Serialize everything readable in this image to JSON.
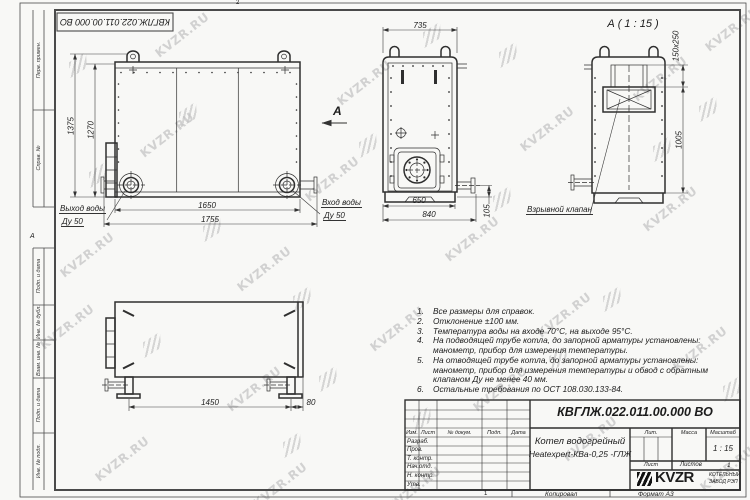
{
  "watermark": {
    "text": "KVZR.RU"
  },
  "frame": {
    "doc_number_rotated": "КВГЛЖ.022.011.00.000 ВО",
    "zone_top": "2",
    "zone_left": "А",
    "zone_bottom": "1",
    "fields": {
      "perv": "Перв. примен.",
      "sprav": "Справ. №",
      "podp1": "Подп. и дата",
      "inv_dubl": "Инв. № дубл.",
      "vzam": "Взам. инв. №",
      "podp2": "Подп. и дата",
      "inv_podl": "Инв. № подл."
    }
  },
  "front_view": {
    "dim_1375": "1375",
    "dim_1270": "1270",
    "dim_1650": "1650",
    "dim_1755": "1755",
    "outlet_label": "Выход воды",
    "outlet_dn": "Ду 50",
    "inlet_label": "Вход воды",
    "inlet_dn": "Ду 50",
    "arrow_label": "А"
  },
  "side_view": {
    "dim_735": "735",
    "dim_650": "650",
    "dim_840": "840",
    "dim_105": "105"
  },
  "section_view": {
    "title": "А ( 1 : 15 )",
    "dim_valve": "150x250",
    "dim_1005": "1005",
    "valve_label": "Взрывной клапан"
  },
  "top_view": {
    "dim_1450": "1450",
    "dim_80": "80"
  },
  "notes": [
    {
      "num": "1.",
      "text": "Все размеры для справок."
    },
    {
      "num": "2.",
      "text": "Отклонение ±100 мм."
    },
    {
      "num": "3.",
      "text": "Температура воды на входе 70°С, на выходе 95°С."
    },
    {
      "num": "4.",
      "text": "На подводящей трубе котла, до запорной арматуры установлены: манометр, прибор для измерения температуры."
    },
    {
      "num": "5.",
      "text": "На отводящей трубе котла, до запорной арматуры установлены: манометр, прибор для измерения температуры и обвод с обратным клапаном Ду не менее 40 мм."
    },
    {
      "num": "6.",
      "text": "Остальные требования по ОСТ 108.030.133-84."
    }
  ],
  "title_block": {
    "doc_number": "КВГЛЖ.022.011.00.000 ВО",
    "name_line1": "Котел водогрейный",
    "name_line2": "Heatexpert-КВа-0,25 -ГЛЖ",
    "col_izm": "Изм.",
    "col_list": "Лист",
    "col_doc": "№ докум.",
    "col_podp": "Подп.",
    "col_data": "Дата",
    "row_razrab": "Разраб.",
    "row_prov": "Пров.",
    "row_tkontr": "Т. контр.",
    "row_nachotd": "Нач.отд.",
    "row_nkontr": "Н. контр.",
    "row_utv": "Утв.",
    "lit": "Лит.",
    "mass": "Масса",
    "scale": "Масштаб",
    "scale_value": "1 : 15",
    "sheet": "Лист",
    "sheets": "Листов",
    "sheets_value": "1",
    "logo_text": "KVZR",
    "company_line1": "КОТЕЛЬНЫЙ",
    "company_line2": "ЗАВОД РЭП"
  },
  "footer": {
    "copied": "Копировал",
    "format": "Формат А3"
  }
}
